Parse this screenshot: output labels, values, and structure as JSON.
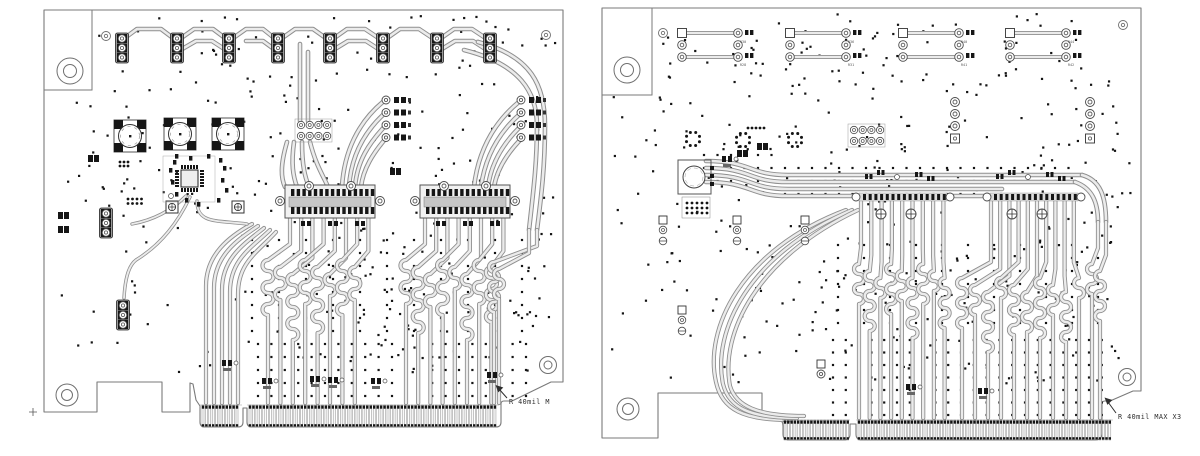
{
  "annotations": {
    "left": {
      "text": "R 40mil M"
    },
    "right": {
      "text": "R 40mil MAX X3"
    }
  },
  "colors": {
    "bg": "#ffffff",
    "outline": "#7a7a7a",
    "trace_edge": "#8f8f8f",
    "trace_core": "#ebebeb",
    "pad": "#161616",
    "comp": "#3c3c3c",
    "via": "#141414",
    "label": "#555555"
  },
  "pcb": {
    "boards": [
      {
        "id": "board-left",
        "outline": "M44,10 H563 V382 H551 L512,401 H504 Q501,401 501,404 V422 Q501,427 496,427 H252 Q247,427 247,422 V408 H243 V422 Q243,427 238,427 H205 Q200,427 200,422 V406 L196,400 L193,384 L190,383 V412 H162 V382 H97 V412 H44 Z",
        "bracket": "M92,10 V90 H44",
        "datum": {
          "x": 33,
          "y": 412
        },
        "via": {
          "seed": 7,
          "count": 330,
          "x": 50,
          "y": 16,
          "w": 506,
          "h": 358,
          "sparse": {
            "x": 50,
            "y": 238,
            "w": 185,
            "h": 140,
            "keep": 0.42
          },
          "skip": [
            [
              44,
              10,
              50,
              82
            ],
            [
              536,
              350,
              30,
              34
            ],
            [
              52,
              382,
              52,
              32
            ]
          ]
        },
        "grids": [
          {
            "x": 258,
            "y": 344,
            "dx": 13.4,
            "dy": 13,
            "nx": 21,
            "ny": 5
          },
          {
            "x": 252,
            "y": 240,
            "dx": 27,
            "dy": 13,
            "nx": 11,
            "ny": 8
          }
        ],
        "rows": [],
        "t46": [
          "M122,40 L137,29 L161,29 L177,41 L194,29 L213,29 L229,41 L246,29 L263,29 L278,41 L295,29 L313,29 L330,41 L347,29 L365,29 L383,41 L400,29 L419,29 L437,41 L454,29 L472,29 L490,41",
          "M177,52 L196,41 L212,41 L229,52",
          "M246,41 L263,41 L278,52",
          "M330,52 L348,41 L366,41 L383,52",
          "M437,52 L455,41 L473,41 L490,52",
          "M300,44 V121",
          "M308,52 V121",
          "M294,142 C291,164 293,176 297,187",
          "M302,142 C302,166 305,177 309,187",
          "M310,142 C316,166 324,177 328,187",
          "M287,142 C280,166 281,178 285,187",
          "M384,101 C358,122 344,152 342,187",
          "M385,113 C364,132 351,156 349,187",
          "M386,125 C369,143 357,161 355,187",
          "M387,137 C373,153 363,169 361,187",
          "M520,101 C493,123 478,152 474,187",
          "M521,113 C498,133 485,157 481,187",
          "M522,125 C503,143 491,163 488,187",
          "M523,137 C507,153 497,169 494,187",
          "M478,42 C532,56 545,86 545,126 C545,168 541,198 537,230",
          "M464,50 C520,64 537,92 537,126 C537,164 533,194 529,230"
        ],
        "t42": [
          "M252,224 C230,236 206,254 206,286 V403",
          "M258,226 C237,240 214,256 214,288 V403",
          "M264,228 C244,244 222,258 222,290 V403",
          "M270,230 C251,248 230,260 230,292 V403",
          "M276,232 C258,252 238,262 238,294 V403"
        ],
        "t36": [
          "M190,197 C178,222 162,244 136,260 C128,266 125,280 124,298",
          "M197,201 C197,224 216,220 247,224",
          "M186,196 C172,210 154,220 132,224"
        ],
        "bundles": [
          {
            "n": 8,
            "xT0": 290,
            "dxT": 11.2,
            "yT": 216,
            "xB0": 268,
            "dxB": 12.4,
            "yS": 260,
            "amp": 5.5,
            "humps": [
              5,
              3,
              6,
              4,
              6,
              2,
              5,
              3
            ],
            "yB": 403
          },
          {
            "n": 8,
            "xT0": 425,
            "dxT": 11.2,
            "yT": 216,
            "xB0": 406,
            "dxB": 12.2,
            "yS": 260,
            "amp": 5.5,
            "humps": [
              4,
              6,
              3,
              5,
              2,
              6,
              4,
              5
            ],
            "yB": 403
          },
          {
            "n": 2,
            "xT0": 537,
            "dxT": -8,
            "yT": 230,
            "xB0": 494,
            "dxB": 5,
            "yS": 262,
            "amp": 5,
            "humps": [
              5,
              3
            ],
            "yB": 403
          }
        ],
        "comps": [
          {
            "t": "tp3",
            "x": 122,
            "y": 33
          },
          {
            "t": "tp3",
            "x": 177,
            "y": 33
          },
          {
            "t": "tp3",
            "x": 229,
            "y": 33
          },
          {
            "t": "tp3",
            "x": 278,
            "y": 33
          },
          {
            "t": "tp3",
            "x": 330,
            "y": 33
          },
          {
            "t": "tp3",
            "x": 383,
            "y": 33
          },
          {
            "t": "tp3",
            "x": 437,
            "y": 33
          },
          {
            "t": "tp3",
            "x": 490,
            "y": 33
          },
          {
            "t": "tp3",
            "x": 106,
            "y": 208
          },
          {
            "t": "tp3",
            "x": 123,
            "y": 300
          },
          {
            "t": "sqpad",
            "x": 172,
            "y": 207
          },
          {
            "t": "sqpad",
            "x": 238,
            "y": 207
          },
          {
            "t": "circ",
            "x": 114,
            "y": 120
          },
          {
            "t": "circ",
            "x": 164,
            "y": 118
          },
          {
            "t": "circ",
            "x": 212,
            "y": 118
          },
          {
            "t": "qfn",
            "x": 163,
            "y": 156
          },
          {
            "t": "grid24",
            "x": 297,
            "y": 121
          },
          {
            "t": "quad",
            "x": 382,
            "y": 97
          },
          {
            "t": "quad",
            "x": 517,
            "y": 97
          },
          {
            "t": "hconn",
            "x": 285,
            "y": 185
          },
          {
            "t": "hconn",
            "x": 420,
            "y": 185
          },
          {
            "t": "dots",
            "x": 128,
            "y": 199,
            "c": 4,
            "r": 2,
            "p": 4.5
          },
          {
            "t": "dots",
            "x": 120,
            "y": 162,
            "c": 3,
            "r": 2,
            "p": 4
          },
          {
            "t": "res",
            "x": 58,
            "y": 212
          },
          {
            "t": "res",
            "x": 58,
            "y": 226
          },
          {
            "t": "res",
            "x": 88,
            "y": 155
          },
          {
            "t": "res",
            "x": 390,
            "y": 168
          },
          {
            "t": "clus",
            "x": 222,
            "y": 360
          },
          {
            "t": "clus",
            "x": 262,
            "y": 378
          },
          {
            "t": "clus",
            "x": 310,
            "y": 376
          },
          {
            "t": "clus",
            "x": 371,
            "y": 378
          },
          {
            "t": "clus",
            "x": 487,
            "y": 372
          },
          {
            "t": "clus",
            "x": 328,
            "y": 377
          }
        ],
        "conns": [
          {
            "x": 200,
            "w": 42,
            "y": 405,
            "h": 22,
            "pitch": 3.4
          },
          {
            "x": 247,
            "w": 252,
            "y": 405,
            "h": 22,
            "pitch": 3.45
          }
        ],
        "holes": [
          {
            "x": 70,
            "y": 71,
            "r1": 13,
            "r2": 6.5
          },
          {
            "x": 67,
            "y": 395,
            "r1": 11,
            "r2": 5.5
          },
          {
            "x": 548,
            "y": 365,
            "r1": 8.5,
            "r2": 4
          }
        ],
        "fids": [
          {
            "x": 106,
            "y": 36
          },
          {
            "x": 546,
            "y": 35
          }
        ]
      },
      {
        "id": "board-right",
        "outline": "M602,8 H1141 V391 H1133 L1110,401 H1105 Q1102,401 1102,404 V433 Q1102,440 1095,440 H862 Q856,440 856,434 V424 H850 V434 Q850,440 844,440 H789 Q783,440 783,434 V426 Q783,420 777,417 H762 V393 H658 V438 H602 Z",
        "bracket": "M652,8 V95 H602",
        "datum": null,
        "via": {
          "seed": 13,
          "count": 390,
          "x": 608,
          "y": 14,
          "w": 524,
          "h": 370,
          "sparse": {
            "x": 608,
            "y": 200,
            "w": 95,
            "h": 180,
            "keep": 0.5
          },
          "skip": [
            [
              602,
              8,
              52,
              88
            ],
            [
              1112,
              362,
              30,
              30
            ],
            [
              606,
              382,
              58,
              30
            ]
          ]
        },
        "grids": [
          {
            "x": 833,
            "y": 340,
            "dx": 12.8,
            "dy": 12.5,
            "nx": 22,
            "ny": 7
          },
          {
            "x": 838,
            "y": 245,
            "dx": 26,
            "dy": 13,
            "nx": 11,
            "ny": 7
          }
        ],
        "rows": [
          {
            "y": 168,
            "x0": 704,
            "x1": 1080,
            "p": 13.5,
            "step": 778,
            "drop": 13
          },
          {
            "y": 181,
            "x0": 704,
            "x1": 1072,
            "p": 13.5,
            "step": 778,
            "drop": 13
          },
          {
            "y": 194,
            "x0": 704,
            "x1": 1004,
            "p": 13.5,
            "step": 778,
            "drop": 13
          }
        ],
        "t46": [
          "M706,161 C752,161 748,175 788,175 H1082",
          "M706,168 C752,168 748,182 788,182 H1075",
          "M706,175 C752,175 748,189 788,189 H1002",
          "M706,182 C752,182 748,196 788,196 H994",
          "M1082,175 C1100,180 1106,196 1106,222",
          "M1075,182 C1092,188 1098,202 1098,222"
        ],
        "t42": [
          "M846,210 C740,250 704,330 716,382 C722,410 744,420 790,420",
          "M852,210 C748,254 712,332 723,384 C729,408 750,418 797,418",
          "M858,210 C756,258 720,334 730,386 C736,406 757,416 804,416"
        ],
        "t36": [],
        "bundles": [
          {
            "n": 9,
            "xT0": 861,
            "dxT": 10.3,
            "yT": 201,
            "xB0": 859,
            "dxB": 10.7,
            "yS": 264,
            "amp": 5,
            "humps": [
              4,
              6,
              2,
              5,
              3,
              6,
              4,
              2,
              5
            ],
            "yB": 418
          },
          {
            "n": 10,
            "xT0": 991,
            "dxT": 9.2,
            "yT": 201,
            "xB0": 962,
            "dxB": 13,
            "yS": 278,
            "amp": 5,
            "humps": [
              5,
              3,
              6,
              2,
              5,
              4,
              6,
              3,
              5,
              2
            ],
            "yB": 418
          },
          {
            "n": 2,
            "xT0": 1098,
            "dxT": 8,
            "yT": 222,
            "xB0": 1092,
            "dxB": 8,
            "yS": 264,
            "amp": 5,
            "humps": [
              3,
              5
            ],
            "yB": 418
          }
        ],
        "comps": [
          {
            "t": "hpair",
            "x": 682,
            "y": 29,
            "li": 0
          },
          {
            "t": "hpair",
            "x": 790,
            "y": 29,
            "li": 1
          },
          {
            "t": "hpair",
            "x": 903,
            "y": 29,
            "li": 2
          },
          {
            "t": "hpair",
            "x": 1010,
            "y": 29,
            "li": 3
          },
          {
            "t": "dcirc",
            "x": 693,
            "y": 139
          },
          {
            "t": "dcirc",
            "x": 743,
            "y": 140
          },
          {
            "t": "dcirc",
            "x": 795,
            "y": 140
          },
          {
            "t": "bigsq",
            "x": 678,
            "y": 160
          },
          {
            "t": "grid24",
            "x": 850,
            "y": 126
          },
          {
            "t": "col4",
            "x": 955,
            "y": 98
          },
          {
            "t": "col4",
            "x": 1090,
            "y": 98
          },
          {
            "t": "rfrow",
            "x": 855,
            "y": 188
          },
          {
            "t": "rfrow",
            "x": 986,
            "y": 188
          },
          {
            "t": "col3s",
            "x": 663,
            "y": 216
          },
          {
            "t": "col3s",
            "x": 737,
            "y": 216
          },
          {
            "t": "col3s",
            "x": 805,
            "y": 216
          },
          {
            "t": "col3s",
            "x": 682,
            "y": 306
          },
          {
            "t": "sqc",
            "x": 821,
            "y": 360
          },
          {
            "t": "clus",
            "x": 906,
            "y": 384
          },
          {
            "t": "clus",
            "x": 978,
            "y": 388
          },
          {
            "t": "res",
            "x": 737,
            "y": 150
          },
          {
            "t": "res",
            "x": 757,
            "y": 143
          },
          {
            "t": "clus",
            "x": 722,
            "y": 156
          },
          {
            "t": "dots",
            "x": 748,
            "y": 128,
            "c": 5,
            "r": 1,
            "p": 4
          }
        ],
        "conns": [
          {
            "x": 782,
            "w": 68,
            "y": 420,
            "h": 20,
            "pitch": 3.3
          },
          {
            "x": 856,
            "w": 257,
            "y": 420,
            "h": 20,
            "pitch": 3.3
          }
        ],
        "holes": [
          {
            "x": 627,
            "y": 70,
            "r1": 13,
            "r2": 6.5
          },
          {
            "x": 628,
            "y": 409,
            "r1": 11,
            "r2": 5.5
          },
          {
            "x": 1127,
            "y": 377,
            "r1": 8.5,
            "r2": 4
          }
        ],
        "fids": [
          {
            "x": 663,
            "y": 33
          },
          {
            "x": 1123,
            "y": 25
          }
        ]
      }
    ],
    "ref_labels": [
      {
        "top": "R30",
        "bot": "R28"
      },
      {
        "top": "R36",
        "bot": "R31"
      },
      {
        "top": "R40",
        "bot": "R41"
      },
      {
        "top": "R44",
        "bot": "R42"
      }
    ]
  }
}
